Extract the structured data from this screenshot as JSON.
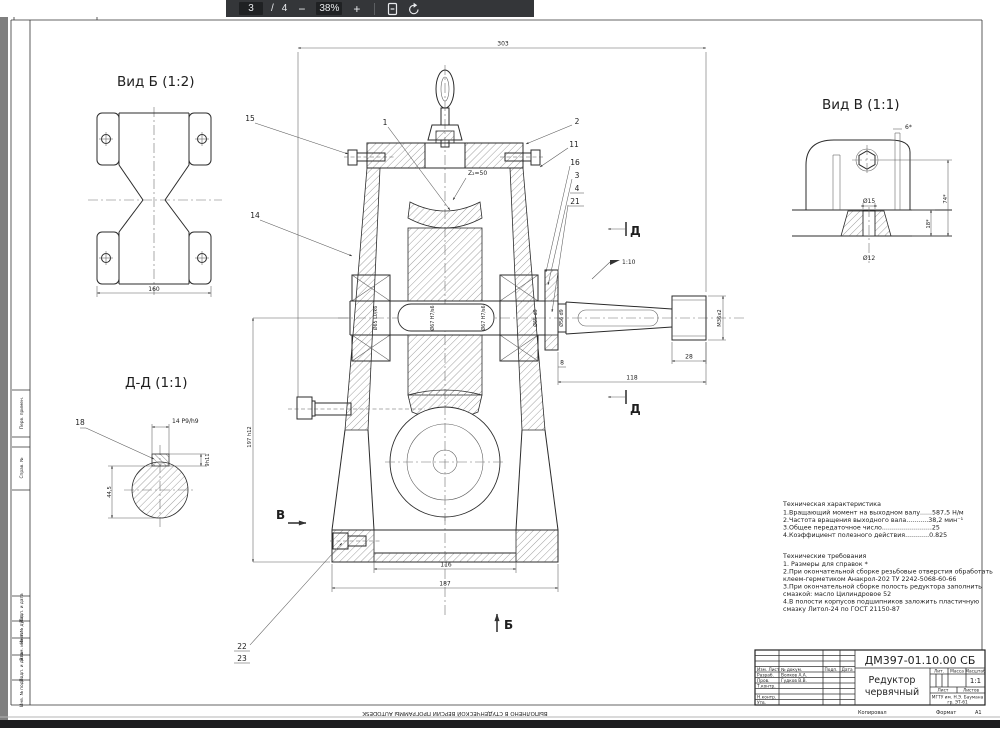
{
  "viewer": {
    "page": "3",
    "separator": "/",
    "page_total": "4",
    "zoom_out": "−",
    "zoom_level": "38%",
    "zoom_in": "+"
  },
  "sheet": {
    "views": {
      "vid_b": {
        "title": "Вид Б (1:2)",
        "dim_width": "160"
      },
      "dd": {
        "title": "Д-Д (1:1)",
        "callout_key": "18",
        "dim_key_width": "14 P9/h9",
        "dim_key_depth": "9h11",
        "dim_section": "44,5"
      },
      "vid_v": {
        "title": "Вид В (1:1)",
        "dim_angle": "6*",
        "dim_height": "74*",
        "dim_base": "18*",
        "dim_hole_top": "Ø15",
        "dim_hole_bottom": "Ø12"
      }
    },
    "main_view": {
      "dim_overall_width": "303",
      "dim_height": "197 h12",
      "dim_base_inner": "116",
      "dim_base_outer": "187",
      "dim_shaft_length": "118",
      "dim_thread_length": "28",
      "dim_face_gap": "8",
      "taper": "1:10",
      "thread": "M36x2",
      "wheel_teeth": "Z₂=50",
      "shaft_fits": [
        "Ø65 L0/k6",
        "Ø67 H7/s6",
        "Ø67 H7/s6",
        "Ø65 d9",
        "Ø56 d9"
      ],
      "callouts": {
        "c1": "1",
        "c2": "2",
        "c3": "3",
        "c4": "4",
        "c11": "11",
        "c14": "14",
        "c15": "15",
        "c16": "16",
        "c21": "21",
        "c22": "22",
        "c23": "23"
      },
      "sections": {
        "d": "Д",
        "v": "В",
        "b": "Б"
      }
    },
    "tech_characteristics": {
      "title": "Техническая характеристика",
      "lines": [
        "1.Вращающий момент на выходном валу......587,5 Н/м",
        "2.Частота вращения выходного вала...........38,2 мин⁻¹",
        "3.Общее передаточное число.........................25",
        "4.Коэффициент полезного действия............0.825"
      ]
    },
    "tech_requirements": {
      "title": "Технические требования",
      "lines": [
        "1. Размеры для справок *",
        "2.При окончательной сборке резьбовые отверстия обработать",
        "клеем-герметиком Анакрол-202 ТУ 2242-5068-60-66",
        "3.При окончательной сборке полость редуктора заполнить",
        "смазкой: масло Цилиндровое 52",
        "4.В полости корпусов подшипников заложить пластичную",
        "смазку Литол-24 по ГОСТ 21150-87"
      ]
    },
    "title_block": {
      "doc_number": "ДМ397-01.10.00 СБ",
      "product_name_1": "Редуктор",
      "product_name_2": "червячный",
      "scale_value": "1:1",
      "org_line1": "МГТУ им. Н.Э. Баумана",
      "org_line2": "гр. ЭТ-61",
      "hdr_izm": "Изм. Лист",
      "hdr_doc": "№ докум.",
      "hdr_podp": "Подп.",
      "hdr_data": "Дата",
      "row_razrab": "Разраб.",
      "row_razrab_name": "Волков А.А.",
      "row_prov": "Пров.",
      "row_prov_name": "Гудков В.В.",
      "row_tkontr": "Т.контр.",
      "row_nkontr": "Н.контр.",
      "row_utv": "Утв.",
      "lit": "Лит.",
      "massa": "Масса",
      "masshtab": "Масштаб",
      "list": "Лист",
      "listov": "Листов",
      "copy": "Копировал",
      "format": "Формат",
      "format_value": "А1"
    },
    "frame_labels": [
      "Перв. примен.",
      "Справ. №",
      "Подп. и дата",
      "Инв. № дубл.",
      "Взам. инв. №",
      "Подп. и дата",
      "Инв. № подл."
    ],
    "watermark": "ВЫПОЛНЕНО В СТУДЕНЧЕСКОЙ ВЕРСИИ ПРОГРАММЫ AUTODESK"
  }
}
